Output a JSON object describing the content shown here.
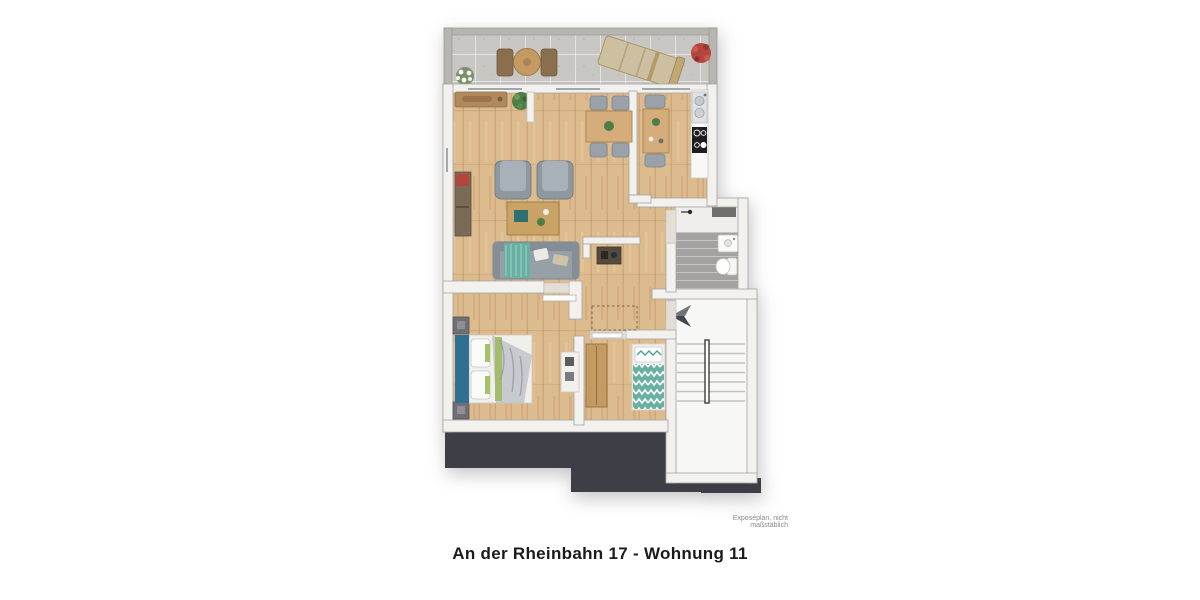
{
  "caption": {
    "title": "An der Rheinbahn 17 - Wohnung 11"
  },
  "footnote": {
    "text": "Exposéplan, nicht maßstäblich"
  },
  "colors": {
    "floor_wood": "#dcbb8f",
    "floor_wood_line": "#b98f5a",
    "balcony_concrete": "#c8c7c4",
    "wall_white": "#f2f1ee",
    "wall_shade": "#a6a5a2",
    "balcony_wall": "#b6b5b1",
    "dark_mass": "#3e3e46",
    "bath_tile": "#a3a2a0",
    "stair_white": "#f7f7f6",
    "sofa_gray": "#979fa7",
    "accent_teal": "#68b0a1",
    "bed_blue": "#2f6f8f",
    "wood_furniture": "#c39a63",
    "plant_green": "#4e7d46",
    "plant_red": "#b5453c"
  }
}
